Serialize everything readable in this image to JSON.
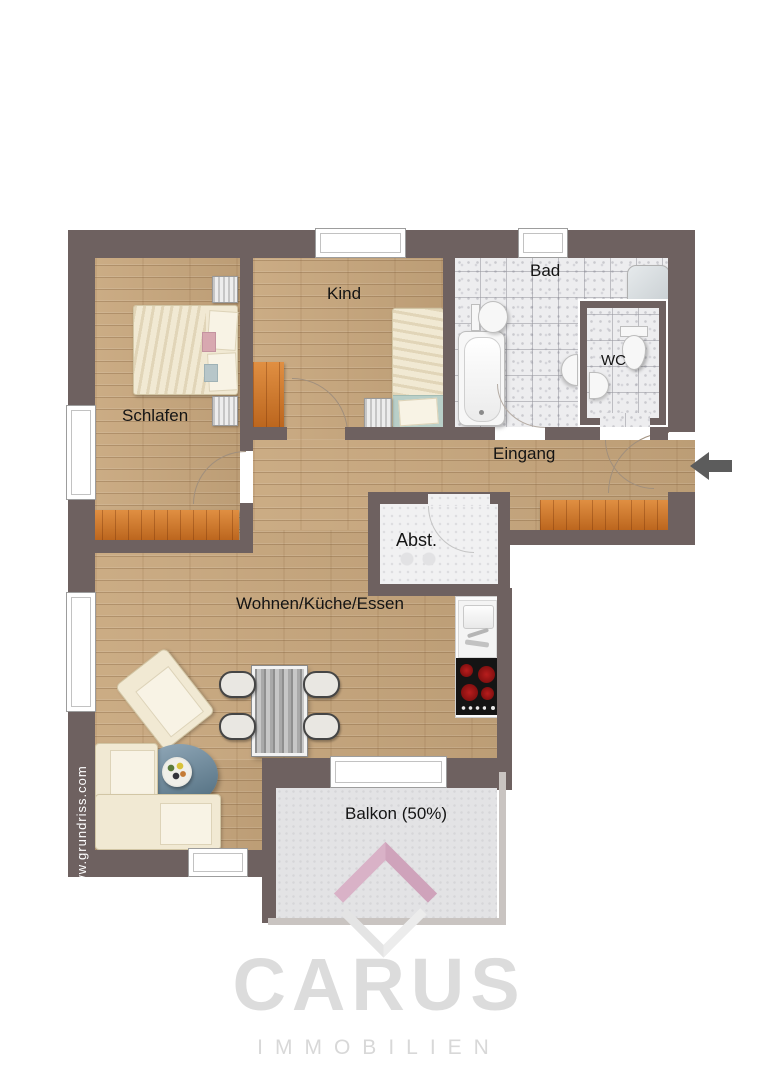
{
  "plan": {
    "type": "apartment-floor-plan",
    "watermark": {
      "text": "www.grundriss.com"
    },
    "rooms": {
      "schlafen": {
        "label": "Schlafen",
        "furniture": [
          "double-bed",
          "nightstand",
          "nightstand",
          "orange-dresser",
          "window"
        ]
      },
      "kind": {
        "label": "Kind",
        "furniture": [
          "single-bed",
          "nightstand",
          "orange-wardrobe",
          "window"
        ]
      },
      "bad": {
        "label": "Bad",
        "furniture": [
          "bathtub",
          "toilet",
          "shower-tray",
          "washbasin",
          "window"
        ]
      },
      "wc": {
        "label": "WC",
        "furniture": [
          "toilet",
          "washbasin"
        ]
      },
      "eingang": {
        "label": "Eingang",
        "furniture": [
          "orange-sideboard",
          "entrance-door"
        ]
      },
      "abstellraum": {
        "label": "Abst.",
        "furniture": [
          "appliances"
        ]
      },
      "wohnen": {
        "label": "Wohnen/Küche/Essen",
        "furniture": [
          "corner-sofa",
          "armchair",
          "coffee-table",
          "fruit-bowl",
          "dining-table",
          "chair",
          "chair",
          "chair",
          "chair",
          "kitchen-sink-unit",
          "stove"
        ]
      },
      "balkon": {
        "label": "Balkon (50%)",
        "furniture": []
      }
    },
    "icons": {
      "entrance_arrow": "arrow-left"
    },
    "colors": {
      "wall": "#6e6160",
      "wood_floor": "#c8a77d",
      "tile_floor": "#ededef",
      "storage_floor": "#f1f1f2",
      "balcony_floor": "#e3e3e5",
      "cabinet_orange": "#cd7227",
      "stove_black": "#141414",
      "burner_red": "#a31414",
      "arrow_gray": "#5c5c5c",
      "logo_pink": "#cfa3bb",
      "logo_gray": "#dcdcdc"
    }
  },
  "branding": {
    "name": "CARUS",
    "subtitle": "IMMOBILIEN"
  }
}
